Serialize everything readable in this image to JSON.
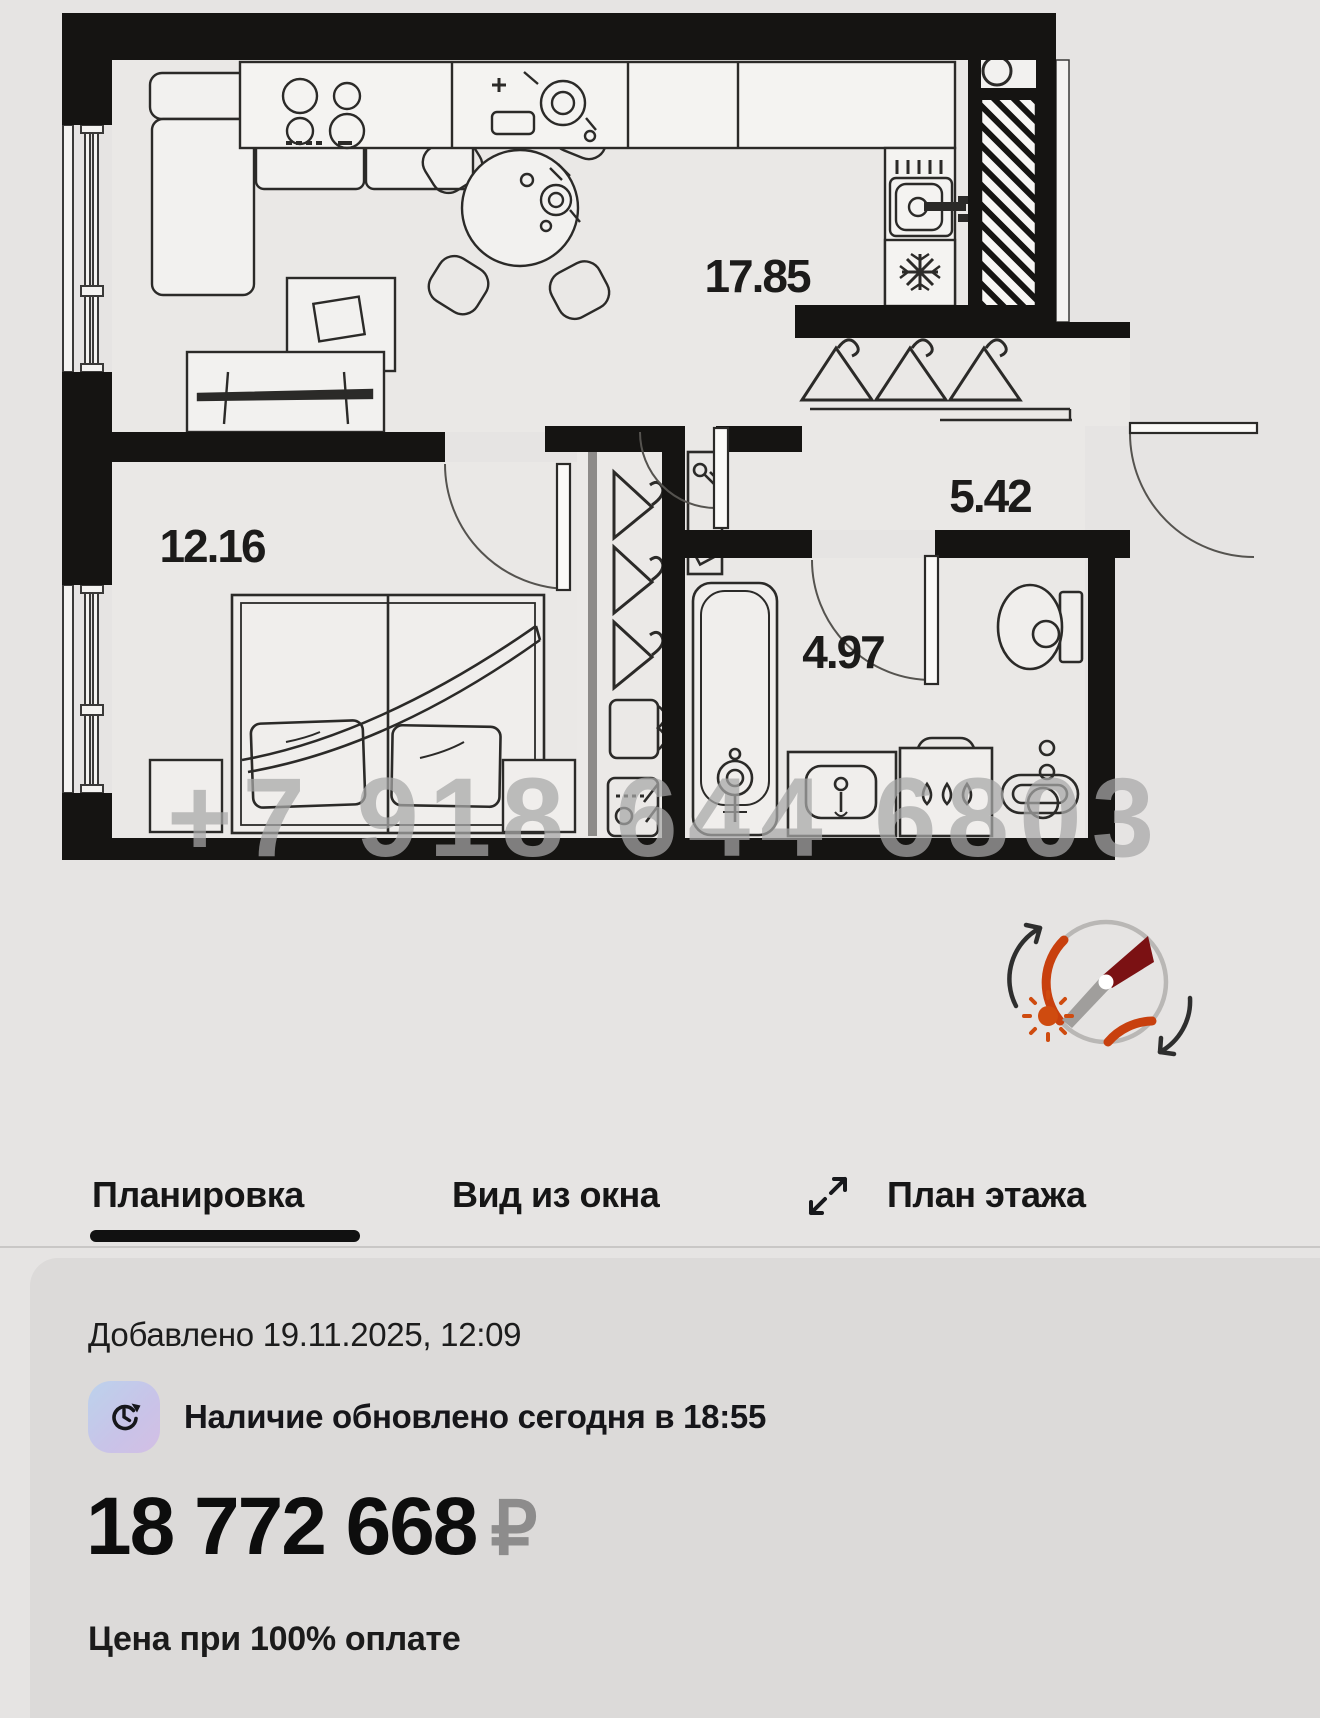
{
  "plan": {
    "area_labels": {
      "kitchen_living": "17.85",
      "bedroom": "12.16",
      "hallway": "5.42",
      "bathroom": "4.97"
    },
    "watermark": "+7 918 644 6803"
  },
  "tabs": {
    "items": [
      {
        "label": "Планировка",
        "active": true
      },
      {
        "label": "Вид из окна",
        "active": false
      },
      {
        "label": "План этажа",
        "active": false
      }
    ]
  },
  "card": {
    "added": "Добавлено 19.11.2025, 12:09",
    "availability": "Наличие обновлено сегодня в 18:55",
    "price": "18 772 668",
    "currency": "₽",
    "price_note": "Цена при 100% оплате"
  },
  "colors": {
    "page_bg": "#e6e4e3",
    "card_bg": "#dcdad9",
    "wall": "#151412",
    "active_tab_underline": "#111111",
    "currency_gray": "#8d8c8c",
    "icon_gradient_from": "#bcd2ec",
    "icon_gradient_to": "#d3bfe4",
    "compass_orange": "#c8400e",
    "compass_needle_red": "#7b1113",
    "watermark_gray": "#a8a8a8"
  }
}
